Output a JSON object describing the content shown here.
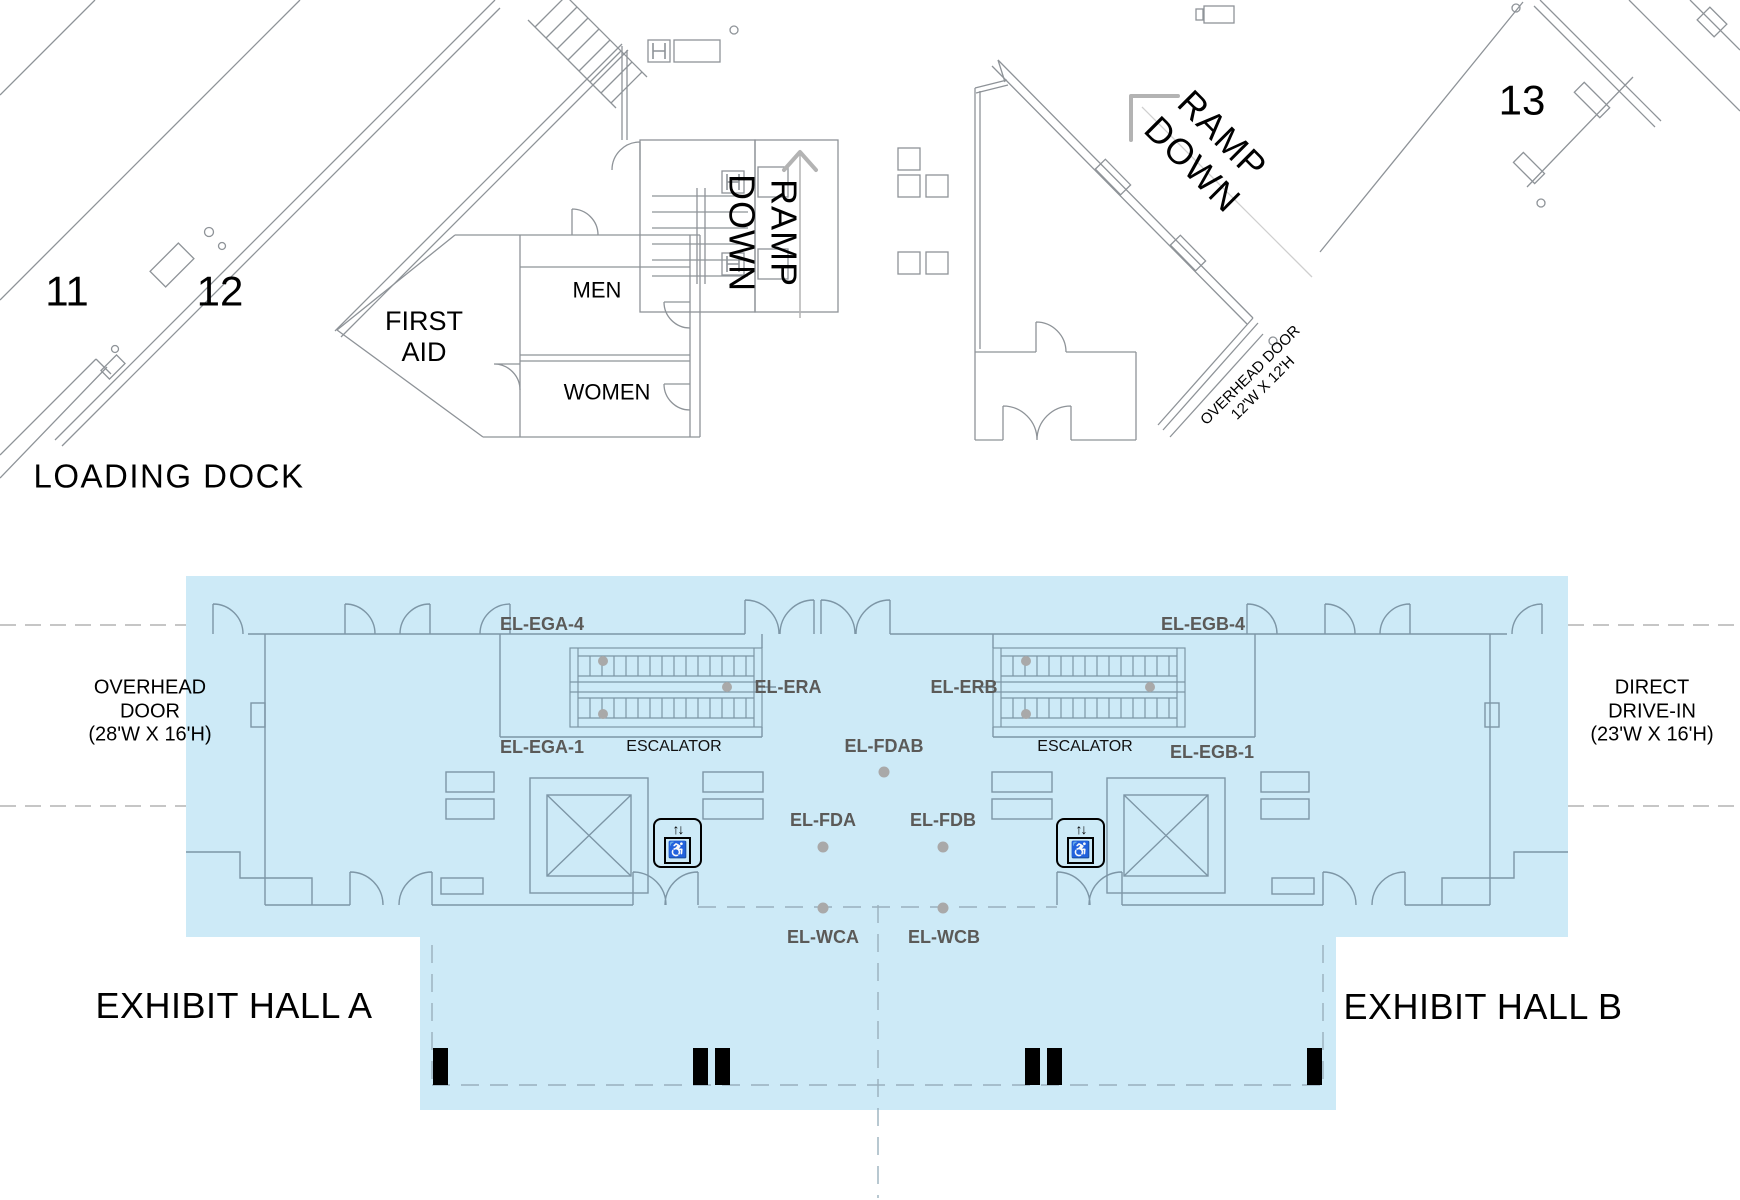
{
  "halls": {
    "loading_dock": "LOADING DOCK",
    "exhibit_hall_a": "EXHIBIT HALL A",
    "exhibit_hall_b": "EXHIBIT HALL B"
  },
  "rooms": {
    "room_11": "11",
    "room_12": "12",
    "room_13": "13",
    "men": "MEN",
    "women": "WOMEN",
    "first_aid_line1": "FIRST",
    "first_aid_line2": "AID"
  },
  "ramps": {
    "vertical_line1": "RAMP",
    "vertical_line2": "DOWN",
    "diagonal_line1": "RAMP",
    "diagonal_line2": "DOWN"
  },
  "door_notes": {
    "overhead_small_line1": "OVERHEAD DOOR",
    "overhead_small_line2": "12'W X 12'H",
    "overhead_large_line1": "OVERHEAD",
    "overhead_large_line2": "DOOR",
    "overhead_large_line3": "(28'W X 16'H)",
    "direct_drive_line1": "DIRECT",
    "direct_drive_line2": "DRIVE-IN",
    "direct_drive_line3": "(23'W X 16'H)"
  },
  "equipment": {
    "el_ega_4": "EL-EGA-4",
    "el_ega_1": "EL-EGA-1",
    "el_era": "EL-ERA",
    "escalator_a": "ESCALATOR",
    "el_egb_4": "EL-EGB-4",
    "el_egb_1": "EL-EGB-1",
    "el_erb": "EL-ERB",
    "escalator_b": "ESCALATOR",
    "el_fdab": "EL-FDAB",
    "el_fda": "EL-FDA",
    "el_fdb": "EL-FDB",
    "el_wca": "EL-WCA",
    "el_wcb": "EL-WCB"
  },
  "icons": {
    "elevator_updown": "↑↓",
    "wheelchair": "♿"
  },
  "colors": {
    "highlight_blue": "#cdeaf7",
    "equipment_label": "#5b5a58",
    "wall_gray": "#8e9398",
    "wall_blue": "#7d96a6",
    "dot_gray": "#a9a9a9"
  }
}
